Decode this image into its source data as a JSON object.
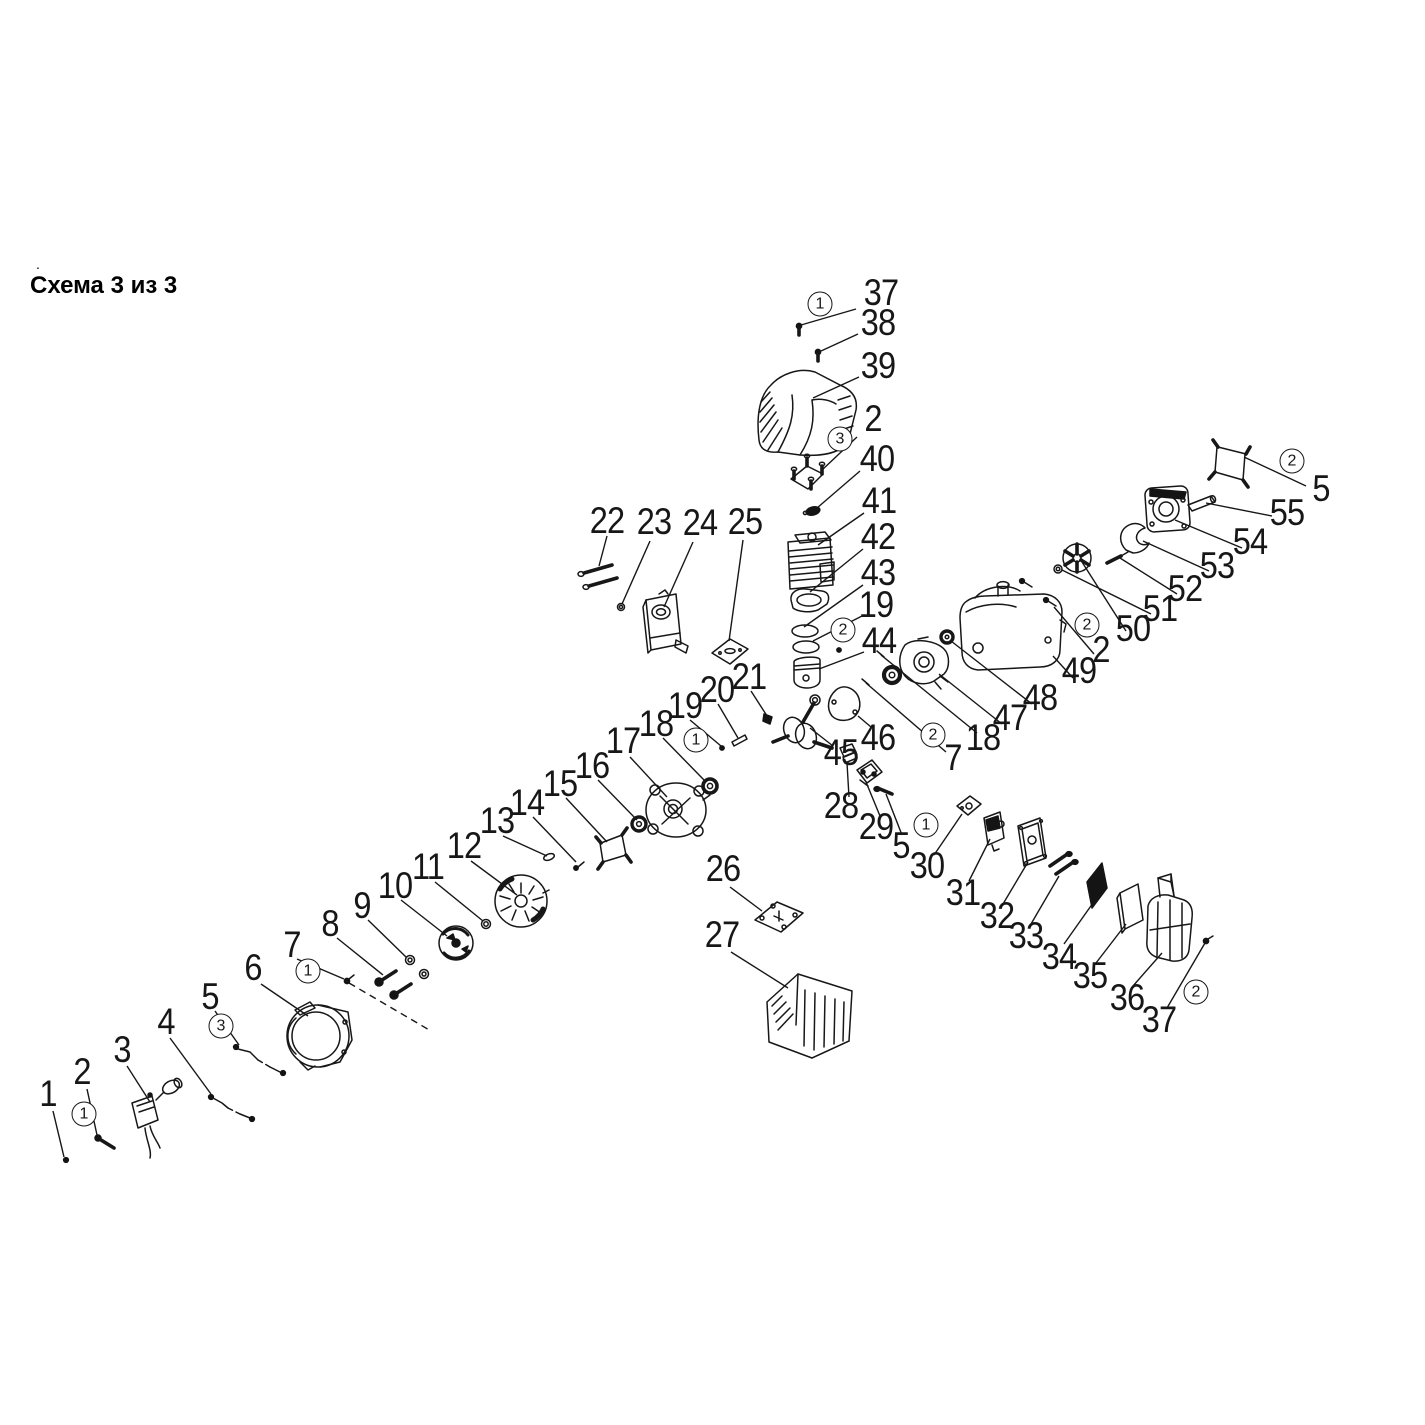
{
  "title": {
    "text": "Схема 3 из 3",
    "dot": "."
  },
  "colors": {
    "line": "#171717",
    "dark_fill": "#141414",
    "background": "#ffffff"
  },
  "labels": [
    {
      "t": "37",
      "x": 881,
      "y": 293
    },
    {
      "t": "38",
      "x": 878,
      "y": 323
    },
    {
      "t": "39",
      "x": 878,
      "y": 366
    },
    {
      "t": "2",
      "x": 873,
      "y": 419
    },
    {
      "t": "40",
      "x": 877,
      "y": 459
    },
    {
      "t": "41",
      "x": 879,
      "y": 501
    },
    {
      "t": "42",
      "x": 878,
      "y": 537
    },
    {
      "t": "43",
      "x": 878,
      "y": 573
    },
    {
      "t": "19",
      "x": 876,
      "y": 605
    },
    {
      "t": "44",
      "x": 879,
      "y": 641
    },
    {
      "t": "22",
      "x": 607,
      "y": 521
    },
    {
      "t": "23",
      "x": 654,
      "y": 522
    },
    {
      "t": "24",
      "x": 700,
      "y": 523
    },
    {
      "t": "25",
      "x": 745,
      "y": 522
    },
    {
      "t": "21",
      "x": 749,
      "y": 677
    },
    {
      "t": "20",
      "x": 717,
      "y": 690
    },
    {
      "t": "19",
      "x": 685,
      "y": 706
    },
    {
      "t": "18",
      "x": 656,
      "y": 724
    },
    {
      "t": "17",
      "x": 623,
      "y": 741
    },
    {
      "t": "16",
      "x": 592,
      "y": 766
    },
    {
      "t": "15",
      "x": 560,
      "y": 784
    },
    {
      "t": "14",
      "x": 527,
      "y": 803
    },
    {
      "t": "13",
      "x": 497,
      "y": 821
    },
    {
      "t": "12",
      "x": 464,
      "y": 846
    },
    {
      "t": "11",
      "x": 428,
      "y": 867
    },
    {
      "t": "10",
      "x": 395,
      "y": 886
    },
    {
      "t": "9",
      "x": 362,
      "y": 906
    },
    {
      "t": "8",
      "x": 330,
      "y": 924
    },
    {
      "t": "7",
      "x": 292,
      "y": 945
    },
    {
      "t": "6",
      "x": 253,
      "y": 968
    },
    {
      "t": "5",
      "x": 210,
      "y": 997
    },
    {
      "t": "4",
      "x": 166,
      "y": 1022
    },
    {
      "t": "3",
      "x": 122,
      "y": 1050
    },
    {
      "t": "2",
      "x": 82,
      "y": 1072
    },
    {
      "t": "1",
      "x": 48,
      "y": 1094
    },
    {
      "t": "26",
      "x": 723,
      "y": 869
    },
    {
      "t": "27",
      "x": 722,
      "y": 935
    },
    {
      "t": "45",
      "x": 841,
      "y": 753
    },
    {
      "t": "46",
      "x": 878,
      "y": 738
    },
    {
      "t": "7",
      "x": 953,
      "y": 758
    },
    {
      "t": "18",
      "x": 983,
      "y": 738
    },
    {
      "t": "47",
      "x": 1010,
      "y": 718
    },
    {
      "t": "48",
      "x": 1040,
      "y": 698
    },
    {
      "t": "28",
      "x": 841,
      "y": 806
    },
    {
      "t": "29",
      "x": 876,
      "y": 827
    },
    {
      "t": "5",
      "x": 901,
      "y": 846
    },
    {
      "t": "30",
      "x": 927,
      "y": 866
    },
    {
      "t": "31",
      "x": 963,
      "y": 893
    },
    {
      "t": "32",
      "x": 997,
      "y": 916
    },
    {
      "t": "33",
      "x": 1026,
      "y": 936
    },
    {
      "t": "34",
      "x": 1059,
      "y": 957
    },
    {
      "t": "35",
      "x": 1090,
      "y": 976
    },
    {
      "t": "36",
      "x": 1127,
      "y": 998
    },
    {
      "t": "37",
      "x": 1159,
      "y": 1020
    },
    {
      "t": "49",
      "x": 1079,
      "y": 671
    },
    {
      "t": "2",
      "x": 1101,
      "y": 650
    },
    {
      "t": "50",
      "x": 1133,
      "y": 629
    },
    {
      "t": "51",
      "x": 1160,
      "y": 609
    },
    {
      "t": "52",
      "x": 1185,
      "y": 589
    },
    {
      "t": "53",
      "x": 1217,
      "y": 566
    },
    {
      "t": "54",
      "x": 1250,
      "y": 542
    },
    {
      "t": "55",
      "x": 1287,
      "y": 513
    },
    {
      "t": "5",
      "x": 1321,
      "y": 489
    }
  ],
  "markers": [
    {
      "t": "1",
      "x": 820,
      "y": 304
    },
    {
      "t": "3",
      "x": 840,
      "y": 439
    },
    {
      "t": "2",
      "x": 843,
      "y": 630
    },
    {
      "t": "1",
      "x": 696,
      "y": 740
    },
    {
      "t": "1",
      "x": 308,
      "y": 971
    },
    {
      "t": "3",
      "x": 221,
      "y": 1026
    },
    {
      "t": "1",
      "x": 84,
      "y": 1114
    },
    {
      "t": "2",
      "x": 933,
      "y": 735
    },
    {
      "t": "1",
      "x": 926,
      "y": 825
    },
    {
      "t": "2",
      "x": 1196,
      "y": 992
    },
    {
      "t": "2",
      "x": 1087,
      "y": 625
    },
    {
      "t": "2",
      "x": 1292,
      "y": 461
    }
  ],
  "leaders": [
    {
      "x1": 856,
      "y1": 309,
      "x2": 801,
      "y2": 325
    },
    {
      "x1": 858,
      "y1": 334,
      "x2": 821,
      "y2": 351
    },
    {
      "x1": 859,
      "y1": 377,
      "x2": 813,
      "y2": 398
    },
    {
      "x1": 857,
      "y1": 437,
      "x2": 822,
      "y2": 470
    },
    {
      "x1": 860,
      "y1": 471,
      "x2": 817,
      "y2": 508
    },
    {
      "x1": 864,
      "y1": 513,
      "x2": 818,
      "y2": 545
    },
    {
      "x1": 863,
      "y1": 549,
      "x2": 810,
      "y2": 592
    },
    {
      "x1": 863,
      "y1": 585,
      "x2": 804,
      "y2": 627
    },
    {
      "x1": 862,
      "y1": 616,
      "x2": 813,
      "y2": 641
    },
    {
      "x1": 864,
      "y1": 652,
      "x2": 819,
      "y2": 669
    },
    {
      "x1": 607,
      "y1": 536,
      "x2": 599,
      "y2": 566
    },
    {
      "x1": 650,
      "y1": 541,
      "x2": 622,
      "y2": 604
    },
    {
      "x1": 693,
      "y1": 542,
      "x2": 664,
      "y2": 607
    },
    {
      "x1": 743,
      "y1": 540,
      "x2": 729,
      "y2": 641
    },
    {
      "x1": 751,
      "y1": 691,
      "x2": 769,
      "y2": 719
    },
    {
      "x1": 718,
      "y1": 704,
      "x2": 738,
      "y2": 738
    },
    {
      "x1": 690,
      "y1": 720,
      "x2": 721,
      "y2": 746
    },
    {
      "x1": 663,
      "y1": 738,
      "x2": 704,
      "y2": 780
    },
    {
      "x1": 630,
      "y1": 757,
      "x2": 667,
      "y2": 797
    },
    {
      "x1": 598,
      "y1": 780,
      "x2": 637,
      "y2": 820
    },
    {
      "x1": 566,
      "y1": 798,
      "x2": 607,
      "y2": 842
    },
    {
      "x1": 533,
      "y1": 817,
      "x2": 576,
      "y2": 862
    },
    {
      "x1": 503,
      "y1": 836,
      "x2": 547,
      "y2": 856
    },
    {
      "x1": 471,
      "y1": 861,
      "x2": 517,
      "y2": 895
    },
    {
      "x1": 435,
      "y1": 882,
      "x2": 483,
      "y2": 921
    },
    {
      "x1": 401,
      "y1": 900,
      "x2": 447,
      "y2": 936
    },
    {
      "x1": 368,
      "y1": 920,
      "x2": 406,
      "y2": 957
    },
    {
      "x1": 337,
      "y1": 938,
      "x2": 383,
      "y2": 975
    },
    {
      "x1": 297,
      "y1": 959,
      "x2": 344,
      "y2": 979
    },
    {
      "x1": 261,
      "y1": 984,
      "x2": 308,
      "y2": 1016
    },
    {
      "x1": 215,
      "y1": 1011,
      "x2": 239,
      "y2": 1045
    },
    {
      "x1": 170,
      "y1": 1038,
      "x2": 211,
      "y2": 1094
    },
    {
      "x1": 127,
      "y1": 1066,
      "x2": 150,
      "y2": 1102
    },
    {
      "x1": 87,
      "y1": 1089,
      "x2": 97,
      "y2": 1135
    },
    {
      "x1": 53,
      "y1": 1111,
      "x2": 64,
      "y2": 1157
    },
    {
      "x1": 730,
      "y1": 887,
      "x2": 762,
      "y2": 911
    },
    {
      "x1": 731,
      "y1": 952,
      "x2": 788,
      "y2": 988
    },
    {
      "x1": 833,
      "y1": 746,
      "x2": 810,
      "y2": 728
    },
    {
      "x1": 871,
      "y1": 727,
      "x2": 858,
      "y2": 716
    },
    {
      "x1": 1002,
      "y1": 724,
      "x2": 939,
      "y2": 674
    },
    {
      "x1": 1032,
      "y1": 704,
      "x2": 951,
      "y2": 641
    },
    {
      "x1": 1073,
      "y1": 678,
      "x2": 1053,
      "y2": 656
    },
    {
      "x1": 1094,
      "y1": 654,
      "x2": 1054,
      "y2": 607
    },
    {
      "x1": 1126,
      "y1": 631,
      "x2": 1082,
      "y2": 562
    },
    {
      "x1": 1151,
      "y1": 614,
      "x2": 1062,
      "y2": 570
    },
    {
      "x1": 1177,
      "y1": 594,
      "x2": 1120,
      "y2": 558
    },
    {
      "x1": 1209,
      "y1": 571,
      "x2": 1143,
      "y2": 541
    },
    {
      "x1": 1242,
      "y1": 548,
      "x2": 1175,
      "y2": 520
    },
    {
      "x1": 1272,
      "y1": 516,
      "x2": 1206,
      "y2": 503
    },
    {
      "x1": 1306,
      "y1": 486,
      "x2": 1244,
      "y2": 457
    },
    {
      "x1": 849,
      "y1": 797,
      "x2": 847,
      "y2": 763
    },
    {
      "x1": 880,
      "y1": 816,
      "x2": 866,
      "y2": 782
    },
    {
      "x1": 902,
      "y1": 835,
      "x2": 886,
      "y2": 794
    },
    {
      "x1": 934,
      "y1": 855,
      "x2": 962,
      "y2": 814
    },
    {
      "x1": 969,
      "y1": 881,
      "x2": 990,
      "y2": 839
    },
    {
      "x1": 1003,
      "y1": 904,
      "x2": 1028,
      "y2": 862
    },
    {
      "x1": 1031,
      "y1": 924,
      "x2": 1059,
      "y2": 876
    },
    {
      "x1": 1064,
      "y1": 944,
      "x2": 1093,
      "y2": 903
    },
    {
      "x1": 1096,
      "y1": 963,
      "x2": 1126,
      "y2": 924
    },
    {
      "x1": 1133,
      "y1": 986,
      "x2": 1162,
      "y2": 953
    },
    {
      "x1": 1167,
      "y1": 1008,
      "x2": 1205,
      "y2": 943
    },
    {
      "x1": 866,
      "y1": 683,
      "x2": 946,
      "y2": 752
    },
    {
      "x1": 881,
      "y1": 655,
      "x2": 977,
      "y2": 733
    },
    {
      "x1": 349,
      "y1": 983,
      "x2": 431,
      "y2": 1031,
      "dash": true
    }
  ]
}
